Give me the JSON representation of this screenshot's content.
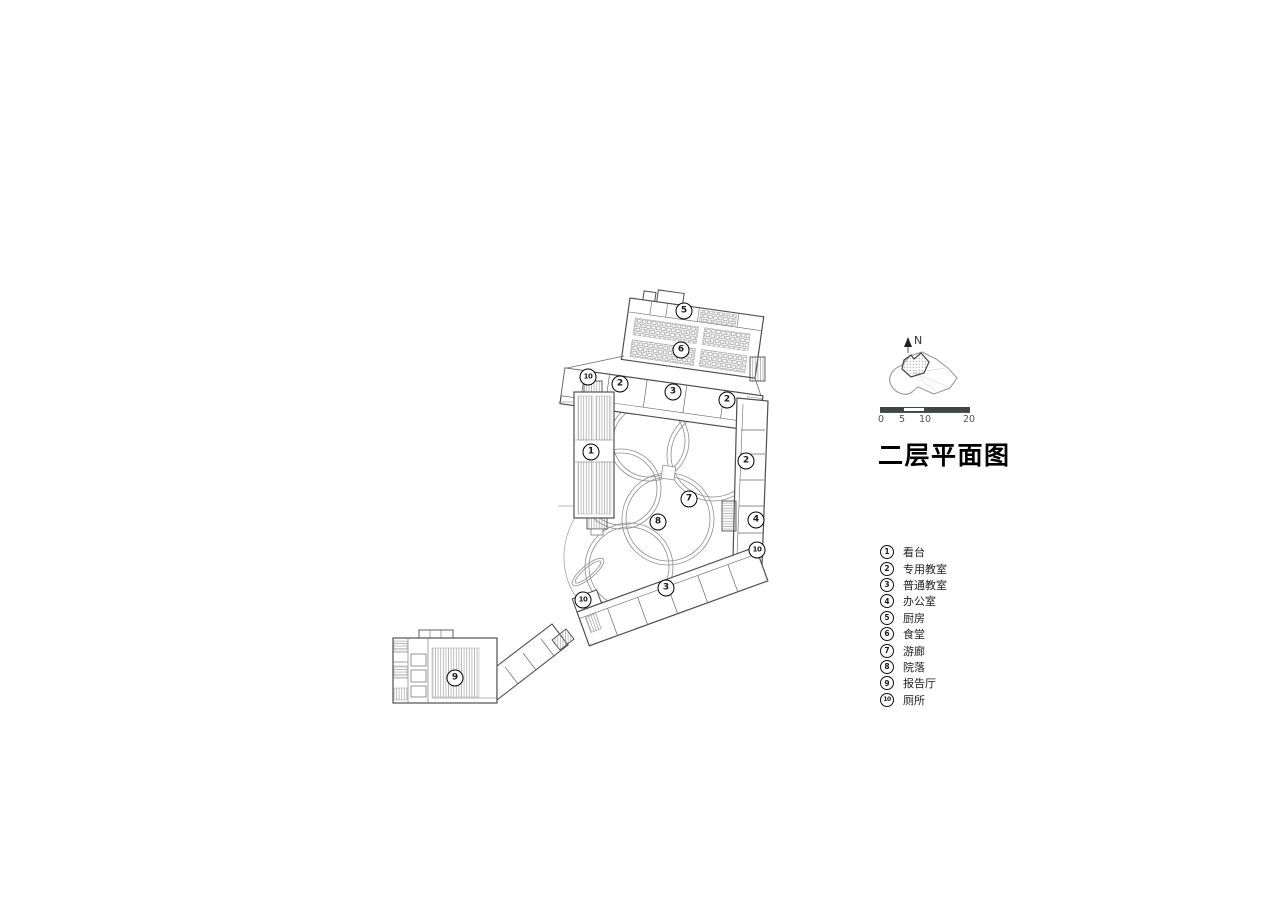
{
  "page": {
    "background": "#ffffff"
  },
  "drawing": {
    "title": "二层平面图",
    "north_label": "N",
    "scale_bar": {
      "labels": [
        "0",
        "5",
        "10",
        "20"
      ],
      "bar_color": "#3d4747"
    },
    "legend": {
      "items": [
        {
          "num": "1",
          "label": "看台"
        },
        {
          "num": "2",
          "label": "专用教室"
        },
        {
          "num": "3",
          "label": "普通教室"
        },
        {
          "num": "4",
          "label": "办公室"
        },
        {
          "num": "5",
          "label": "厨房"
        },
        {
          "num": "6",
          "label": "食堂"
        },
        {
          "num": "7",
          "label": "游廊"
        },
        {
          "num": "8",
          "label": "院落"
        },
        {
          "num": "9",
          "label": "报告厅"
        },
        {
          "num": "10",
          "label": "厕所"
        }
      ]
    },
    "plan": {
      "markers": [
        {
          "num": "5",
          "x": 684,
          "y": 311
        },
        {
          "num": "6",
          "x": 681,
          "y": 350
        },
        {
          "num": "10",
          "x": 588,
          "y": 377
        },
        {
          "num": "2",
          "x": 620,
          "y": 384
        },
        {
          "num": "3",
          "x": 673,
          "y": 392
        },
        {
          "num": "2",
          "x": 727,
          "y": 400
        },
        {
          "num": "1",
          "x": 591,
          "y": 452
        },
        {
          "num": "2",
          "x": 746,
          "y": 461
        },
        {
          "num": "7",
          "x": 689,
          "y": 499
        },
        {
          "num": "8",
          "x": 658,
          "y": 522
        },
        {
          "num": "4",
          "x": 756,
          "y": 520
        },
        {
          "num": "10",
          "x": 757,
          "y": 550
        },
        {
          "num": "3",
          "x": 666,
          "y": 588
        },
        {
          "num": "10",
          "x": 583,
          "y": 600
        },
        {
          "num": "9",
          "x": 455,
          "y": 678
        }
      ]
    },
    "colors": {
      "wall": "#4f4f4f",
      "hatch": "#8a8a8a",
      "path": "#8f8f8f"
    }
  }
}
